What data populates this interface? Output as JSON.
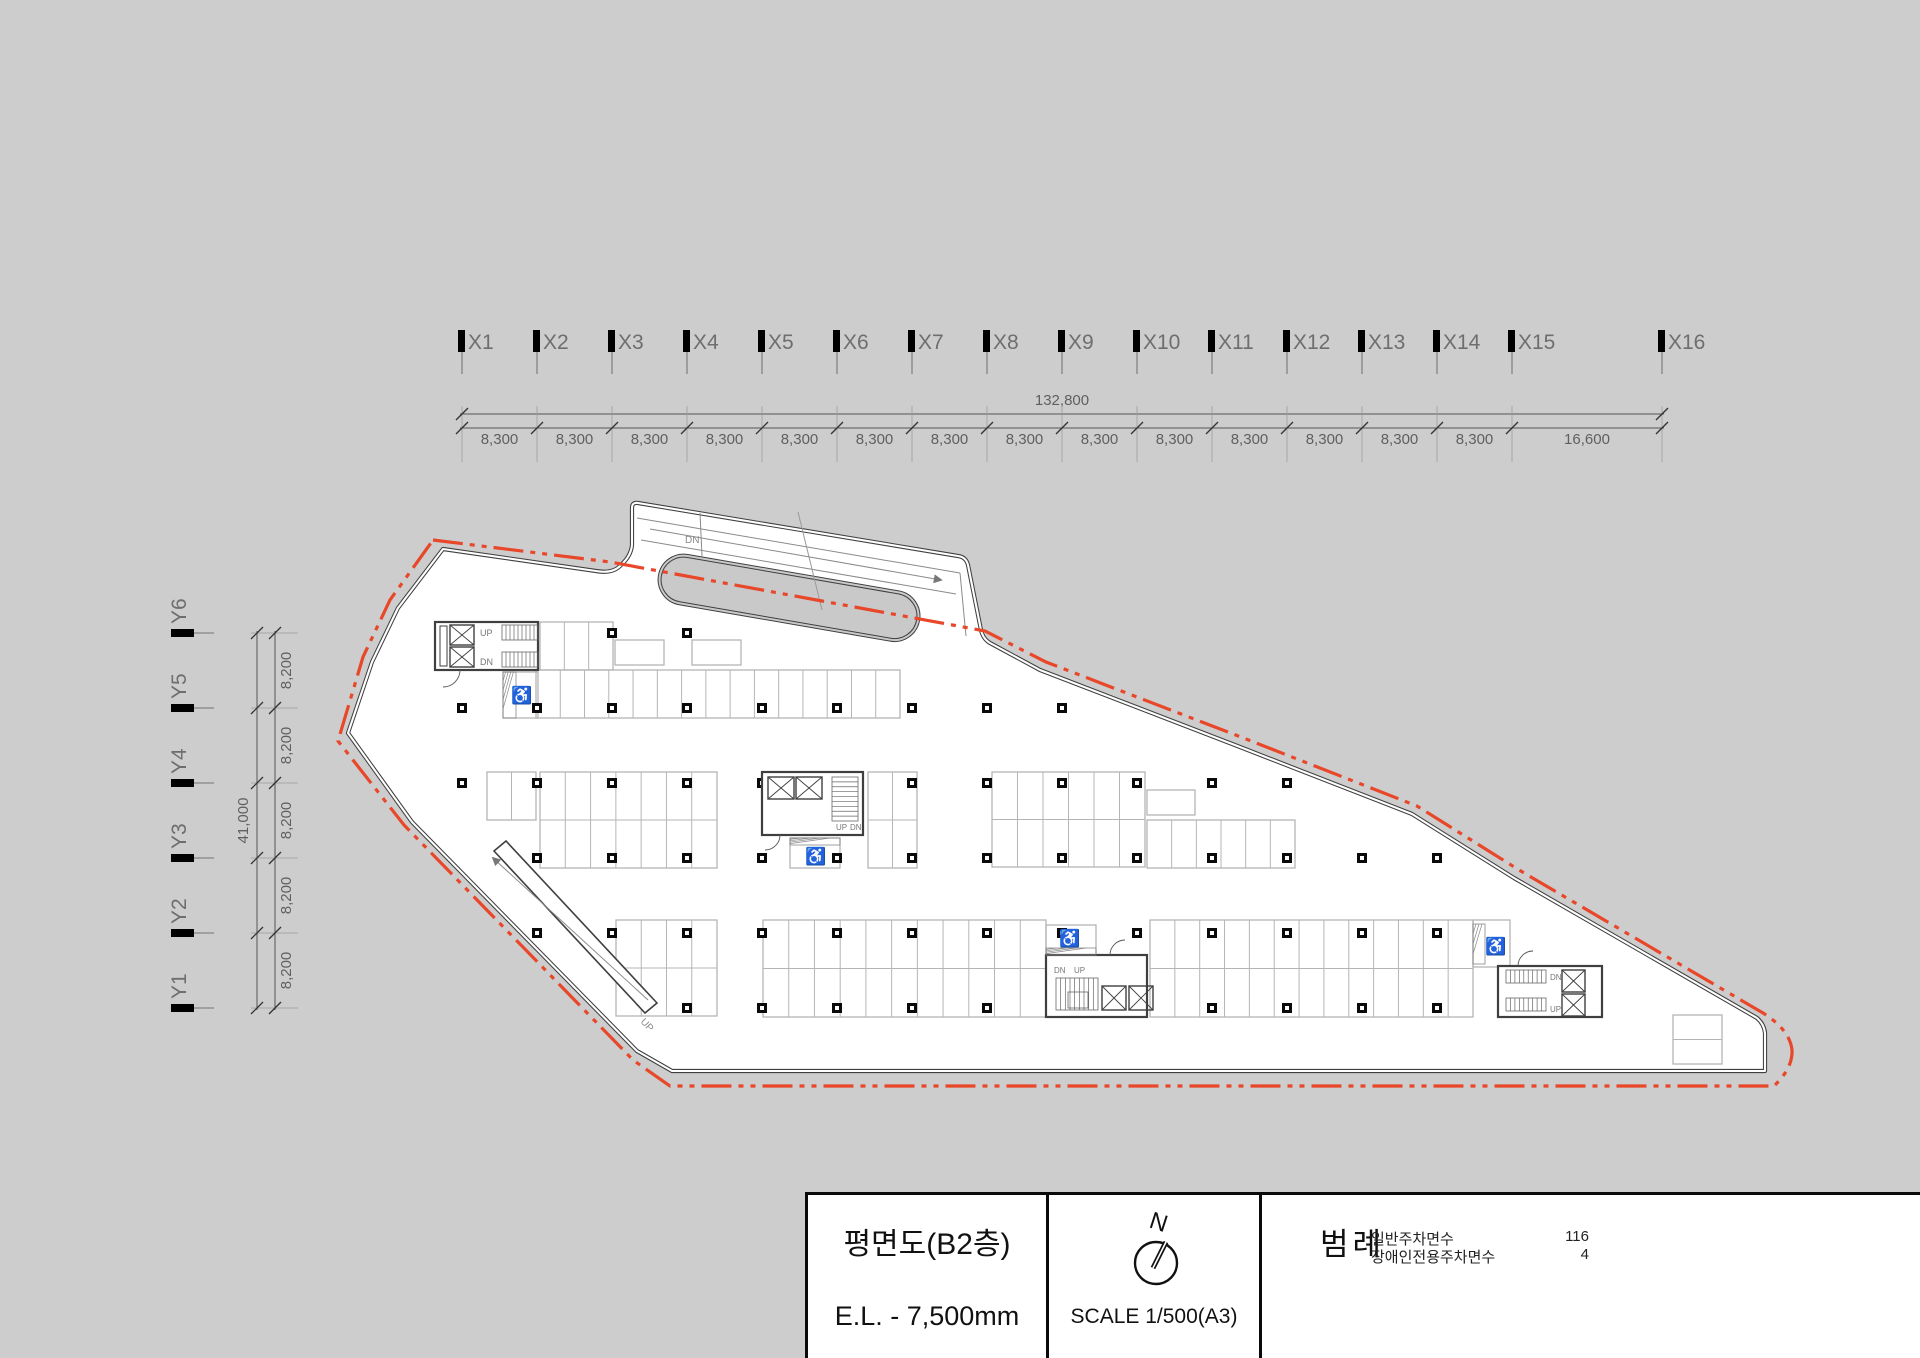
{
  "page": {
    "background": "#cdcdcd"
  },
  "x_axis": {
    "labels": [
      "X1",
      "X2",
      "X3",
      "X4",
      "X5",
      "X6",
      "X7",
      "X8",
      "X9",
      "X10",
      "X11",
      "X12",
      "X13",
      "X14",
      "X15",
      "X16"
    ],
    "segment_labels": [
      "8,300",
      "8,300",
      "8,300",
      "8,300",
      "8,300",
      "8,300",
      "8,300",
      "8,300",
      "8,300",
      "8,300",
      "8,300",
      "8,300",
      "8,300",
      "8,300",
      "16,600"
    ],
    "total_label": "132,800"
  },
  "y_axis": {
    "labels": [
      "Y6",
      "Y5",
      "Y4",
      "Y3",
      "Y2",
      "Y1"
    ],
    "segment_labels": [
      "8,200",
      "8,200",
      "8,200",
      "8,200",
      "8,200"
    ],
    "total_label": "41,000"
  },
  "plan": {
    "up": "UP",
    "dn": "DN",
    "accessible_icon": "♿"
  },
  "colors": {
    "background": "#cdcdcd",
    "wall": "#3f3f3f",
    "building_fill": "#ffffff",
    "stall_line": "#b5b5b5",
    "boundary_red": "#e8472a",
    "dim_text": "#5f5f5f",
    "axis_label": "#6e6e6e"
  },
  "title_block": {
    "title": "평면도(B2층)",
    "elevation": "E.L. - 7,500mm",
    "north_label": "N",
    "scale": "SCALE 1/500(A3)",
    "legend_title": "범례",
    "legend": [
      {
        "label": "일반주차면수",
        "value": "116"
      },
      {
        "label": "장애인전용주차면수",
        "value": "4"
      }
    ]
  }
}
